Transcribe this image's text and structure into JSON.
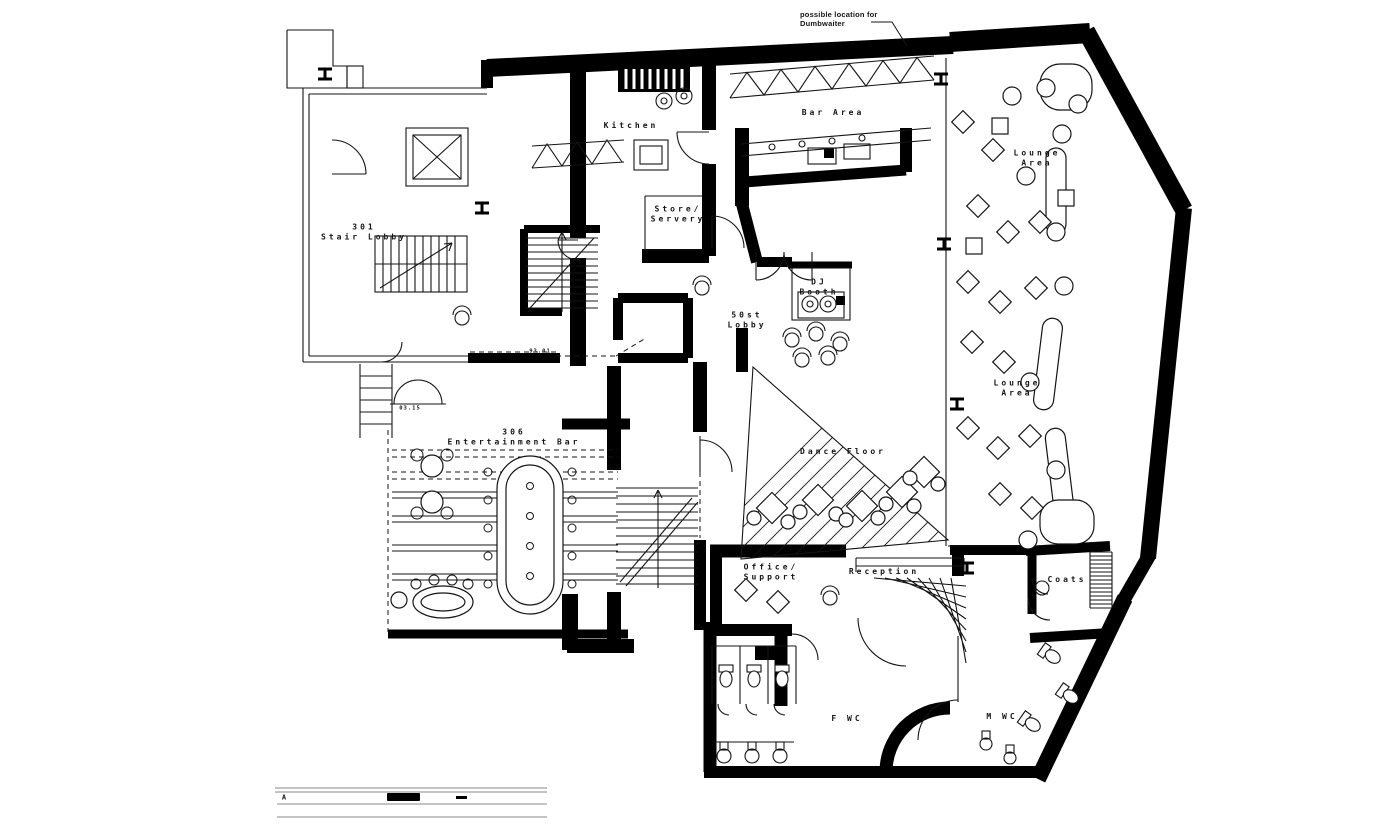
{
  "document": {
    "type": "architectural floor plan",
    "subject": "club / entertainment venue floor"
  },
  "colors": {
    "ink": "#141414",
    "paper": "#ffffff"
  },
  "annotation": {
    "dumbwaiter_note": "possible location for\nDumbwaiter"
  },
  "title_block": {
    "revision": "A"
  },
  "plan": {
    "labels": [
      {
        "name": "dumbwaiter-note",
        "text": "possible location for\nDumbwaiter",
        "x": 800,
        "y": 10,
        "cls": "note"
      },
      {
        "name": "kitchen",
        "text": "Kitchen",
        "x": 631,
        "y": 126
      },
      {
        "name": "bar-area",
        "text": "Bar Area",
        "x": 833,
        "y": 113
      },
      {
        "name": "lounge-area-upper",
        "text": "Lounge\nArea",
        "x": 1037,
        "y": 159
      },
      {
        "name": "lounge-area-lower",
        "text": "Lounge\nArea",
        "x": 1017,
        "y": 389
      },
      {
        "name": "store-servery",
        "text": "Store/\nServery",
        "x": 678,
        "y": 215
      },
      {
        "name": "dj-booth",
        "text": "DJ\nBooth",
        "x": 819,
        "y": 288
      },
      {
        "name": "lobby-50st",
        "text": "50st\nLobby",
        "x": 747,
        "y": 321
      },
      {
        "name": "stair-lobby-301",
        "text": "301\nStair Lobby",
        "x": 364,
        "y": 233
      },
      {
        "name": "entertainment-bar-306",
        "text": "306\nEntertainment Bar",
        "x": 514,
        "y": 438
      },
      {
        "name": "dance-floor",
        "text": "Dance Floor",
        "x": 843,
        "y": 452
      },
      {
        "name": "office-support",
        "text": "Office/\nSupport",
        "x": 771,
        "y": 573
      },
      {
        "name": "reception",
        "text": "Reception",
        "x": 884,
        "y": 572
      },
      {
        "name": "coats",
        "text": "Coats",
        "x": 1067,
        "y": 580
      },
      {
        "name": "f-wc",
        "text": "F  WC",
        "x": 847,
        "y": 719
      },
      {
        "name": "m-wc",
        "text": "M  WC",
        "x": 1002,
        "y": 717
      },
      {
        "name": "door-number-9301",
        "text": "93.01",
        "x": 540,
        "y": 352,
        "cls": "tiny"
      },
      {
        "name": "door-number-0315",
        "text": "03.15",
        "x": 410,
        "y": 409,
        "cls": "tiny"
      },
      {
        "name": "revision-letter",
        "text": "A",
        "x": 284,
        "y": 798,
        "cls": "rev"
      }
    ]
  }
}
